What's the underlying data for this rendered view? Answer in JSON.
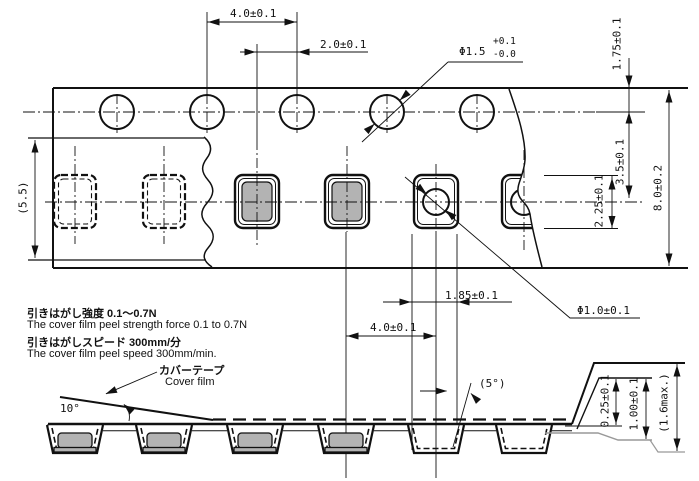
{
  "top": {
    "dim_sprocket_pitch": "4.0±0.1",
    "dim_hole_to_pocket": "2.0±0.1",
    "sprocket_hole_dia": "Φ1.5",
    "sprocket_hole_tol_plus": "+0.1",
    "sprocket_hole_tol_minus": "-0.0",
    "dim_edge_to_hole": "1.75±0.1",
    "dim_hole_to_pocket_center": "3.5±0.1",
    "dim_pocket_height": "2.25±0.1",
    "dim_tape_width": "8.0±0.2",
    "dim_cover_film_width": "(5.5)",
    "dim_pocket_width": "1.85±0.1",
    "dim_pocket_pitch": "4.0±0.1",
    "dim_pocket_hole_dia": "Φ1.0±0.1"
  },
  "notes": {
    "peel_strength_jp": "引きはがし強度 0.1〜0.7N",
    "peel_strength_en": "The cover film peel strength force 0.1 to 0.7N",
    "peel_speed_jp": "引きはがしスピード 300mm/分",
    "peel_speed_en": "The cover film peel speed 300mm/min."
  },
  "side": {
    "cover_film_label_jp": "カバーテープ",
    "cover_film_label_en": "Cover film",
    "peel_angle": "10°",
    "pocket_wall_angle": "(5°)",
    "dim_tape_thickness": "0.25±0.1",
    "dim_pocket_depth": "1.00±0.1",
    "dim_total_thickness": "(1.6max.)"
  },
  "colors": {
    "line": "#111111",
    "component_fill": "#b3b3b3",
    "section_line": "#999999",
    "background": "#ffffff"
  }
}
